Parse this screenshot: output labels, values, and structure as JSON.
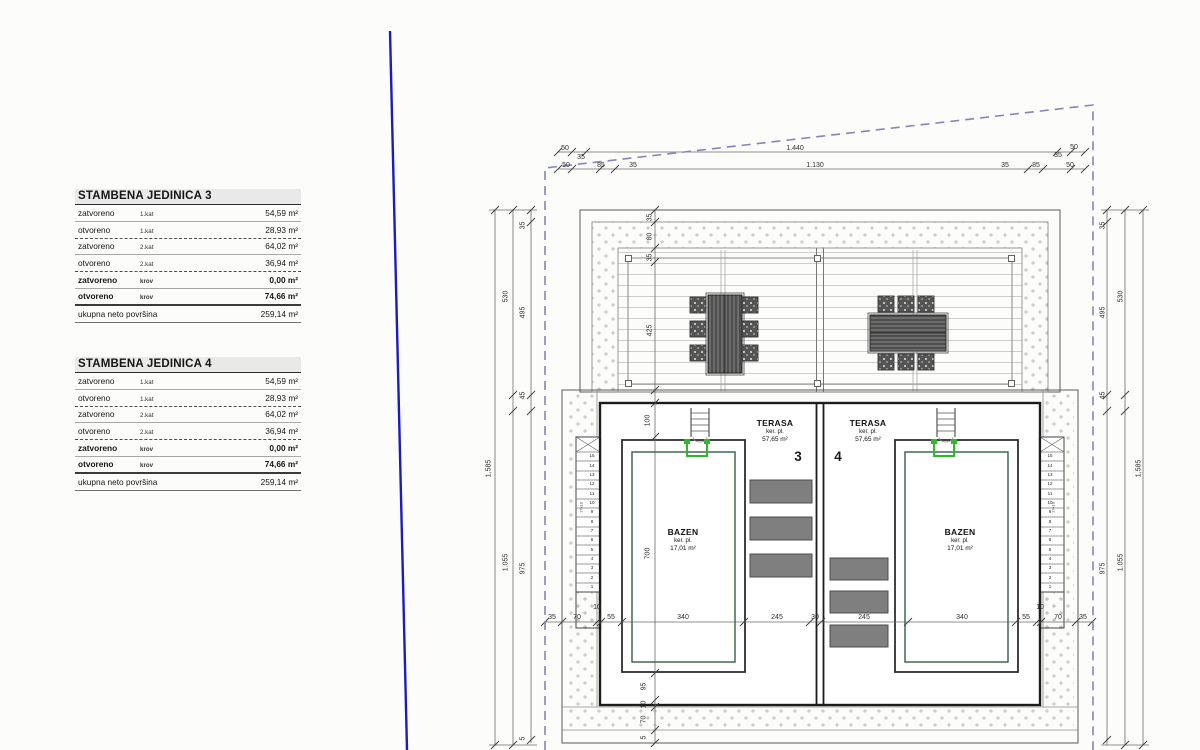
{
  "left_panel": {
    "tables": [
      {
        "title": "STAMBENA JEDINICA 3",
        "rows": [
          {
            "label": "zatvoreno",
            "floor": "1.kat",
            "value": "54,59 m²"
          },
          {
            "label": "otvoreno",
            "floor": "1.kat",
            "value": "28,93 m²"
          },
          {
            "label": "zatvoreno",
            "floor": "2.kat",
            "value": "64,02 m²"
          },
          {
            "label": "otvoreno",
            "floor": "2.kat",
            "value": "36,94 m²"
          },
          {
            "label": "zatvoreno",
            "floor": "krov",
            "value": "0,00 m²"
          },
          {
            "label": "otvoreno",
            "floor": "krov",
            "value": "74,66 m²"
          }
        ],
        "total_label": "ukupna neto površina",
        "total_value": "259,14 m²"
      },
      {
        "title": "STAMBENA JEDINICA 4",
        "rows": [
          {
            "label": "zatvoreno",
            "floor": "1.kat",
            "value": "54,59 m²"
          },
          {
            "label": "otvoreno",
            "floor": "1.kat",
            "value": "28,93 m²"
          },
          {
            "label": "zatvoreno",
            "floor": "2.kat",
            "value": "64,02 m²"
          },
          {
            "label": "otvoreno",
            "floor": "2.kat",
            "value": "36,94 m²"
          },
          {
            "label": "zatvoreno",
            "floor": "krov",
            "value": "0,00 m²"
          },
          {
            "label": "otvoreno",
            "floor": "krov",
            "value": "74,66 m²"
          }
        ],
        "total_label": "ukupna neto površina",
        "total_value": "259,14 m²"
      }
    ]
  },
  "plan": {
    "units": {
      "unit3": "3",
      "unit4": "4"
    },
    "terrace": {
      "name": "TERASA",
      "material": "ker. pl.",
      "area": "57,65 m²"
    },
    "pool": {
      "name": "BAZEN",
      "material": "ker. pl.",
      "area": "17,01 m²"
    },
    "dims": {
      "top1": [
        "50",
        "35",
        "1.440",
        "35",
        "50"
      ],
      "top2": [
        "50",
        "85",
        "35",
        "1.130",
        "35",
        "85",
        "50"
      ],
      "side_inner": [
        "35",
        "495",
        "45",
        "975",
        "5"
      ],
      "side_mid": [
        "530",
        "1.055"
      ],
      "side_outer": "1,585",
      "deck_chain": [
        "35",
        "80",
        "35",
        "425"
      ],
      "lower_chain": [
        "100",
        "700",
        "95",
        "10",
        "70",
        "5"
      ],
      "bottom_chain": [
        "35",
        "70",
        "10",
        "55",
        "340",
        "245",
        "30",
        "245",
        "340",
        "55",
        "10",
        "70",
        "35"
      ]
    },
    "stairs": {
      "numbers": [
        "15",
        "14",
        "13",
        "12",
        "11",
        "10",
        "9",
        "8",
        "7",
        "6",
        "5",
        "4",
        "3",
        "2",
        "1"
      ],
      "note": "17x18"
    }
  },
  "colors": {
    "parcel_boundary": "#8585bd",
    "property_blue_line": "#1b1bc0",
    "pool_ladder_green": "#2eb82e",
    "pool_liner": "#3f6b4f",
    "lounger_gray": "#7f7f7f",
    "table_header_bg": "#e9e9e9"
  }
}
